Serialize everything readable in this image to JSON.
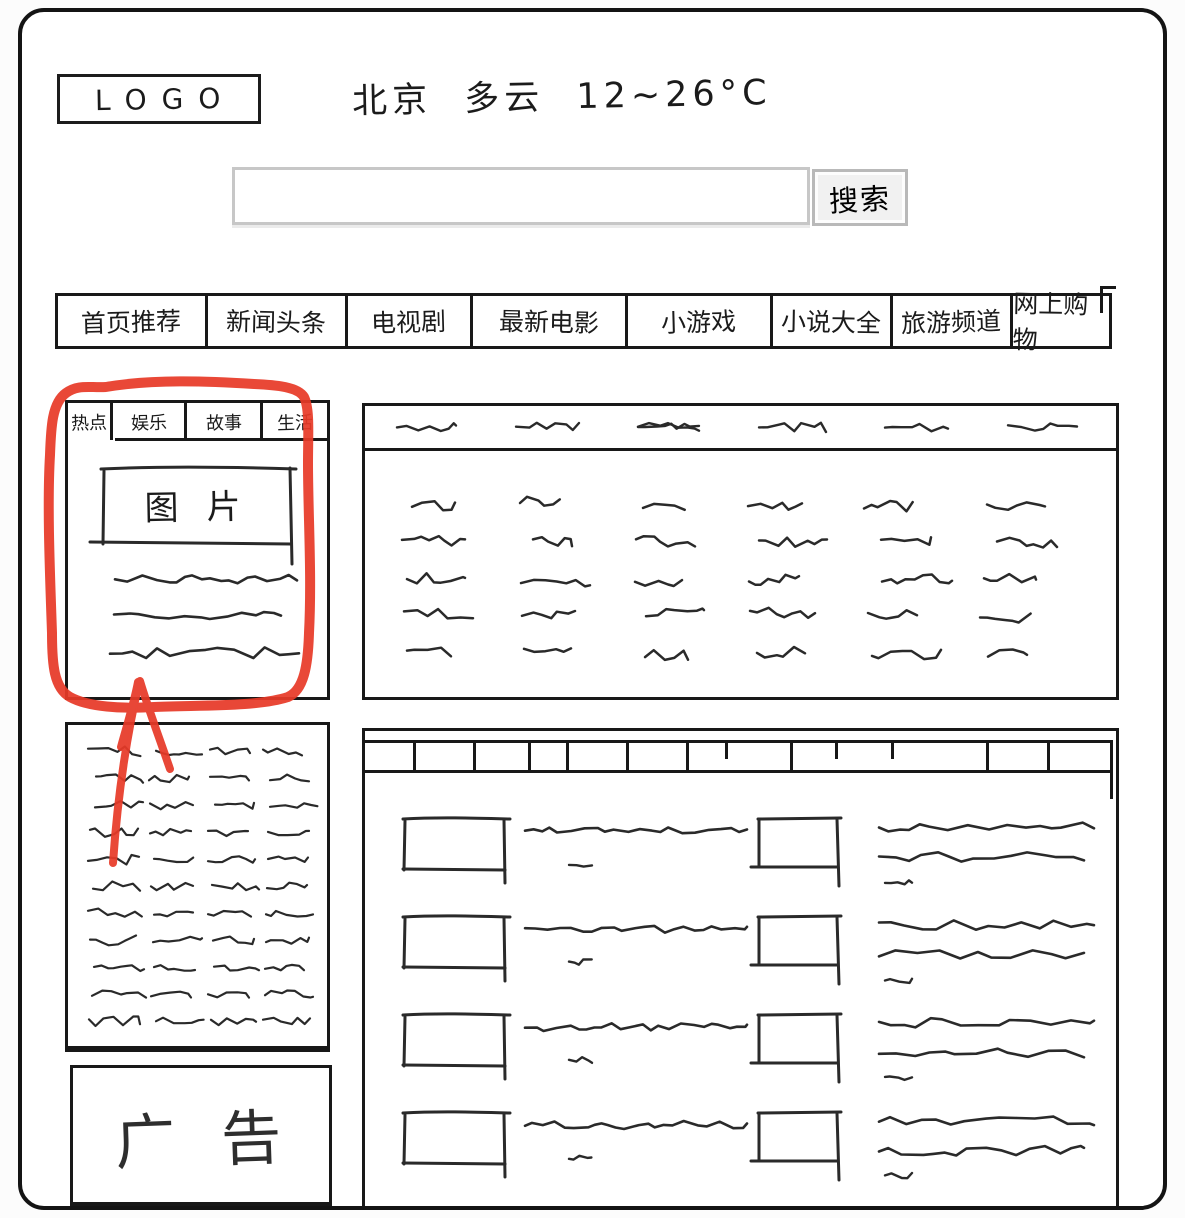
{
  "logo": {
    "text": "LOGO"
  },
  "weather": {
    "city": "北京",
    "condition": "多云",
    "temperature": "12~26°C",
    "display": "北京 多云 12~26°C"
  },
  "search": {
    "input_value": "",
    "input_placeholder": "",
    "button_label": "搜索"
  },
  "nav": {
    "items": [
      "首页推荐",
      "新闻头条",
      "电视剧",
      "最新电影",
      "小游戏",
      "小说大全",
      "旅游频道",
      "网上购物"
    ]
  },
  "hot_module": {
    "tabs": [
      {
        "label": "热点",
        "active": true
      },
      {
        "label": "娱乐",
        "active": false
      },
      {
        "label": "故事",
        "active": false
      },
      {
        "label": "生活",
        "active": false
      }
    ],
    "image_placeholder_label": "图片",
    "headline_line_count": 3
  },
  "annotation": {
    "type": "hand-drawn highlight circle with upward arrow",
    "color": "#e73a28"
  },
  "left_link_list": {
    "columns": 4,
    "rows": 11
  },
  "ad": {
    "label": "广告"
  },
  "news_module": {
    "header_link_count": 6,
    "grid_columns": 6,
    "grid_rows": 5
  },
  "content_module": {
    "header_cell_dividers": 12,
    "list_columns": 2,
    "list_rows": 4
  }
}
